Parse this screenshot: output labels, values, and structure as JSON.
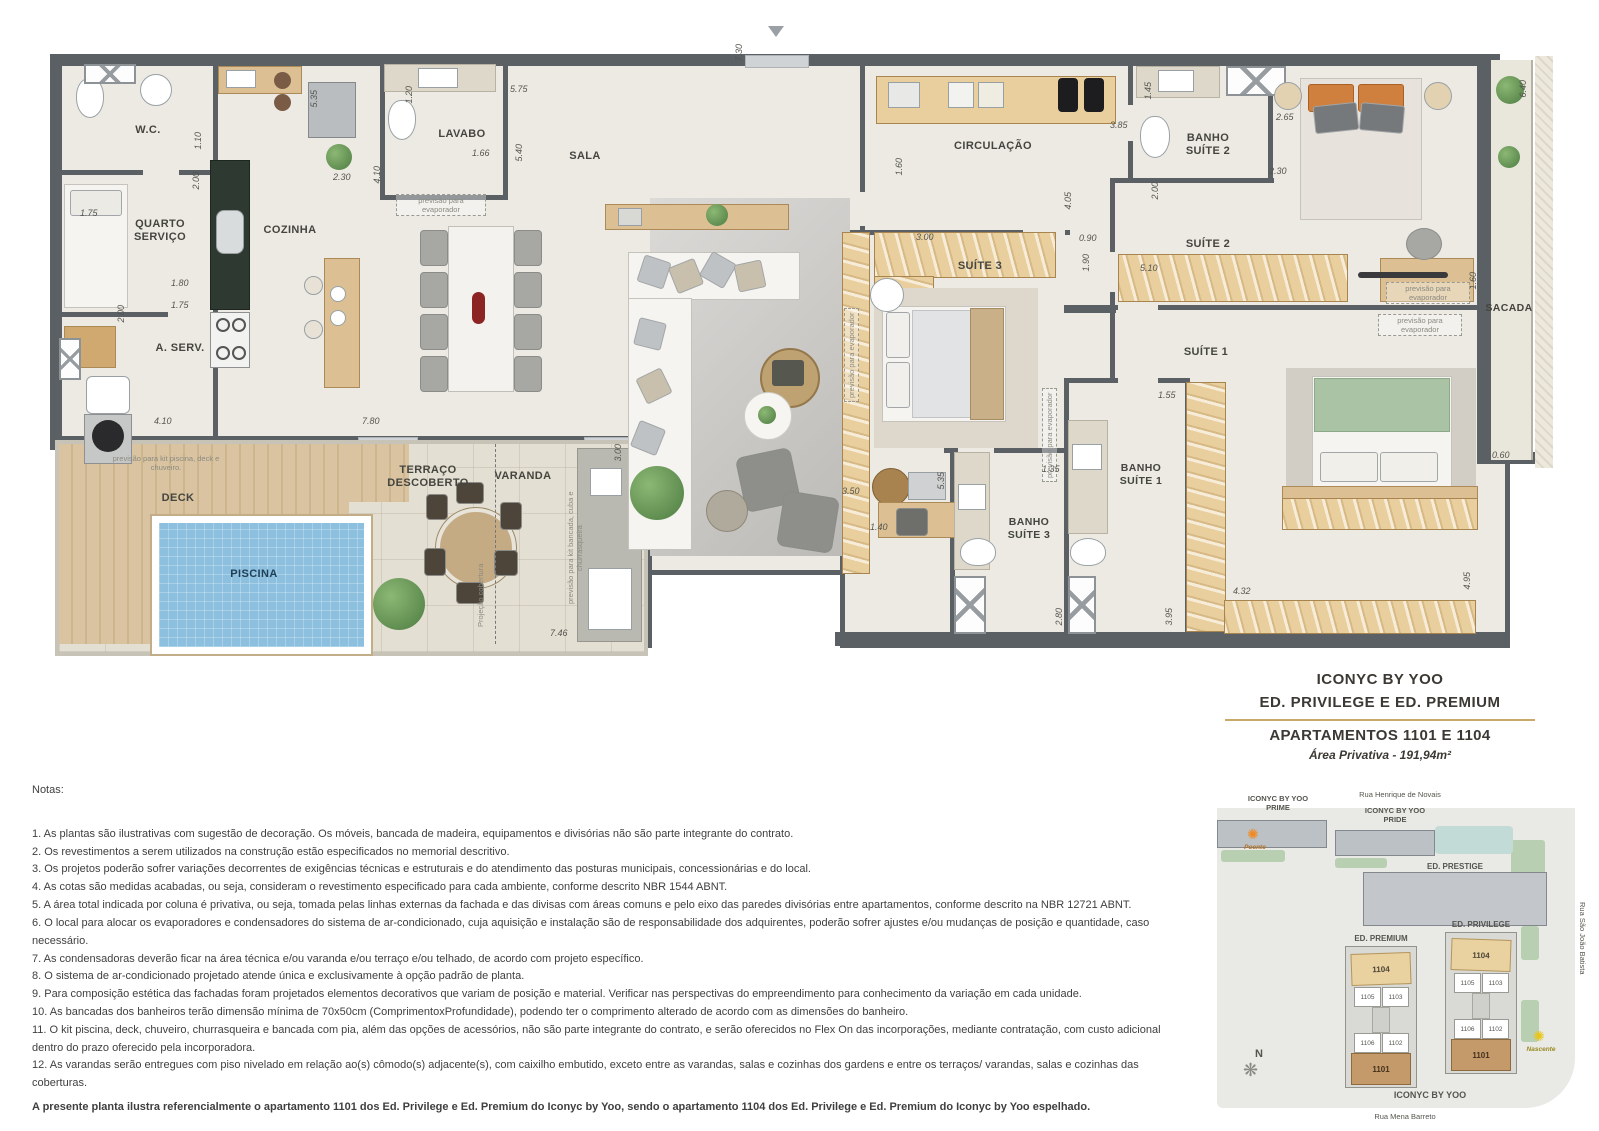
{
  "plan": {
    "rooms": {
      "wc": "W.C.",
      "quarto": "QUARTO\nSERVIÇO",
      "cozinha": "COZINHA",
      "aserv": "A. SERV.",
      "lavabo": "LAVABO",
      "sala": "SALA",
      "circulacao": "CIRCULAÇÃO",
      "banho_suite2": "BANHO\nSUÍTE 2",
      "suite2": "SUÍTE 2",
      "suite3": "SUÍTE 3",
      "suite1": "SUÍTE 1",
      "banho_suite3": "BANHO\nSUÍTE 3",
      "banho_suite1": "BANHO\nSUÍTE 1",
      "sacada": "SACADA",
      "deck": "DECK",
      "piscina": "PISCINA",
      "terraco": "TERRAÇO\nDESCOBERTO",
      "varanda": "VARANDA"
    },
    "annotations": {
      "evaporador": "previsão para evaporador",
      "kit_piscina": "previsão para kit piscina, deck e chuveiro.",
      "kit_bancada": "previsão para kit bancada, cuba e churrasqueira",
      "projecao": "Projeção cobertura"
    },
    "dims": [
      "1.75",
      "1.10",
      "2.00",
      "5.35",
      "1.80",
      "1.75",
      "2.00",
      "4.10",
      "2.30",
      "4.10",
      "1.20",
      "5.75",
      "1.66",
      "5.40",
      "7.30",
      "3.85",
      "1.60",
      "3.00",
      "4.05",
      "0.90",
      "1.90",
      "2.00",
      "1.45",
      "5.10",
      "2.30",
      "2.65",
      "6.40",
      "1.60",
      "0.60",
      "1.55",
      "1.35",
      "5.35",
      "3.50",
      "1.40",
      "2.80",
      "3.95",
      "4.32",
      "4.95",
      "3.00",
      "7.46",
      "7.80"
    ]
  },
  "title_block": {
    "project": "ICONYC BY YOO",
    "buildings": "ED. PRIVILEGE E ED. PREMIUM",
    "apartments": "APARTAMENTOS 1101 E 1104",
    "area": "Área Privativa - 191,94m²"
  },
  "notes": {
    "heading": "Notas:",
    "items": [
      "1. As plantas são ilustrativas com sugestão de decoração. Os móveis, bancada de madeira, equipamentos e divisórias não são parte integrante do contrato.",
      "2. Os revestimentos a serem utilizados na construção estão especificados no memorial descritivo.",
      "3. Os projetos poderão sofrer variações decorrentes de exigências técnicas e estruturais e do atendimento das posturas municipais, concessionárias e do local.",
      "4. As cotas são medidas acabadas, ou seja, consideram o revestimento especificado para cada ambiente, conforme descrito NBR 1544 ABNT.",
      "5. A área total indicada por coluna é privativa, ou seja, tomada pelas linhas externas da fachada e das divisas com áreas comuns e pelo eixo das paredes divisórias entre apartamentos, conforme descrito na NBR 12721 ABNT.",
      "6. O local para alocar os evaporadores e condensadores do sistema de ar-condicionado, cuja aquisição e instalação são de responsabilidade dos adquirentes, poderão sofrer ajustes e/ou mudanças de posição e quantidade, caso necessário.",
      "7. As condensadoras deverão ficar na área técnica e/ou varanda e/ou terraço e/ou telhado, de acordo com projeto específico.",
      "8. O sistema de ar-condicionado projetado atende única e exclusivamente à opção padrão de planta.",
      "9. Para composição estética das fachadas foram projetados elementos decorativos que variam de posição e material. Verificar nas perspectivas do empreendimento para conhecimento da variação em cada unidade.",
      "10. As bancadas dos banheiros terão dimensão mínima de 70x50cm (ComprimentoxProfundidade), podendo ter o comprimento alterado de acordo com as dimensões do banheiro.",
      "11. O kit piscina, deck, chuveiro, churrasqueira e bancada com pia, além das opções de acessórios, não são parte integrante do contrato, e serão oferecidos no Flex On das incorporações, mediante contratação, com custo adicional dentro do prazo oferecido pela incorporadora.",
      "12. As varandas serão entregues com piso nivelado em relação ao(s) cômodo(s) adjacente(s), com caixilho embutido, exceto entre as varandas, salas e cozinhas dos gardens e entre os terraços/ varandas, salas e cozinhas das coberturas."
    ],
    "footer": "A presente planta ilustra referencialmente o apartamento 1101 dos Ed. Privilege e Ed. Premium do Iconyc by Yoo, sendo o apartamento 1104 dos Ed. Privilege e Ed. Premium do Iconyc by Yoo espelhado."
  },
  "sitemap": {
    "streets": {
      "top": "Rua Henrique de Novais",
      "right": "Rua São João Batista",
      "bottom": "Rua Mena Barreto"
    },
    "buildings": {
      "prime": "ICONYC BY YOO\nPRIME",
      "pride": "ICONYC BY YOO\nPRIDE",
      "prestige": "ED. PRESTIGE",
      "premium": "ED. PREMIUM",
      "privilege": "ED. PRIVILEGE",
      "complex": "ICONYC BY YOO"
    },
    "units": {
      "u1104": "1104",
      "u1105": "1105",
      "u1103": "1103",
      "u1106": "1106",
      "u1102": "1102",
      "u1101": "1101"
    },
    "compass": "N",
    "west": "Poente",
    "east": "Nascente"
  }
}
